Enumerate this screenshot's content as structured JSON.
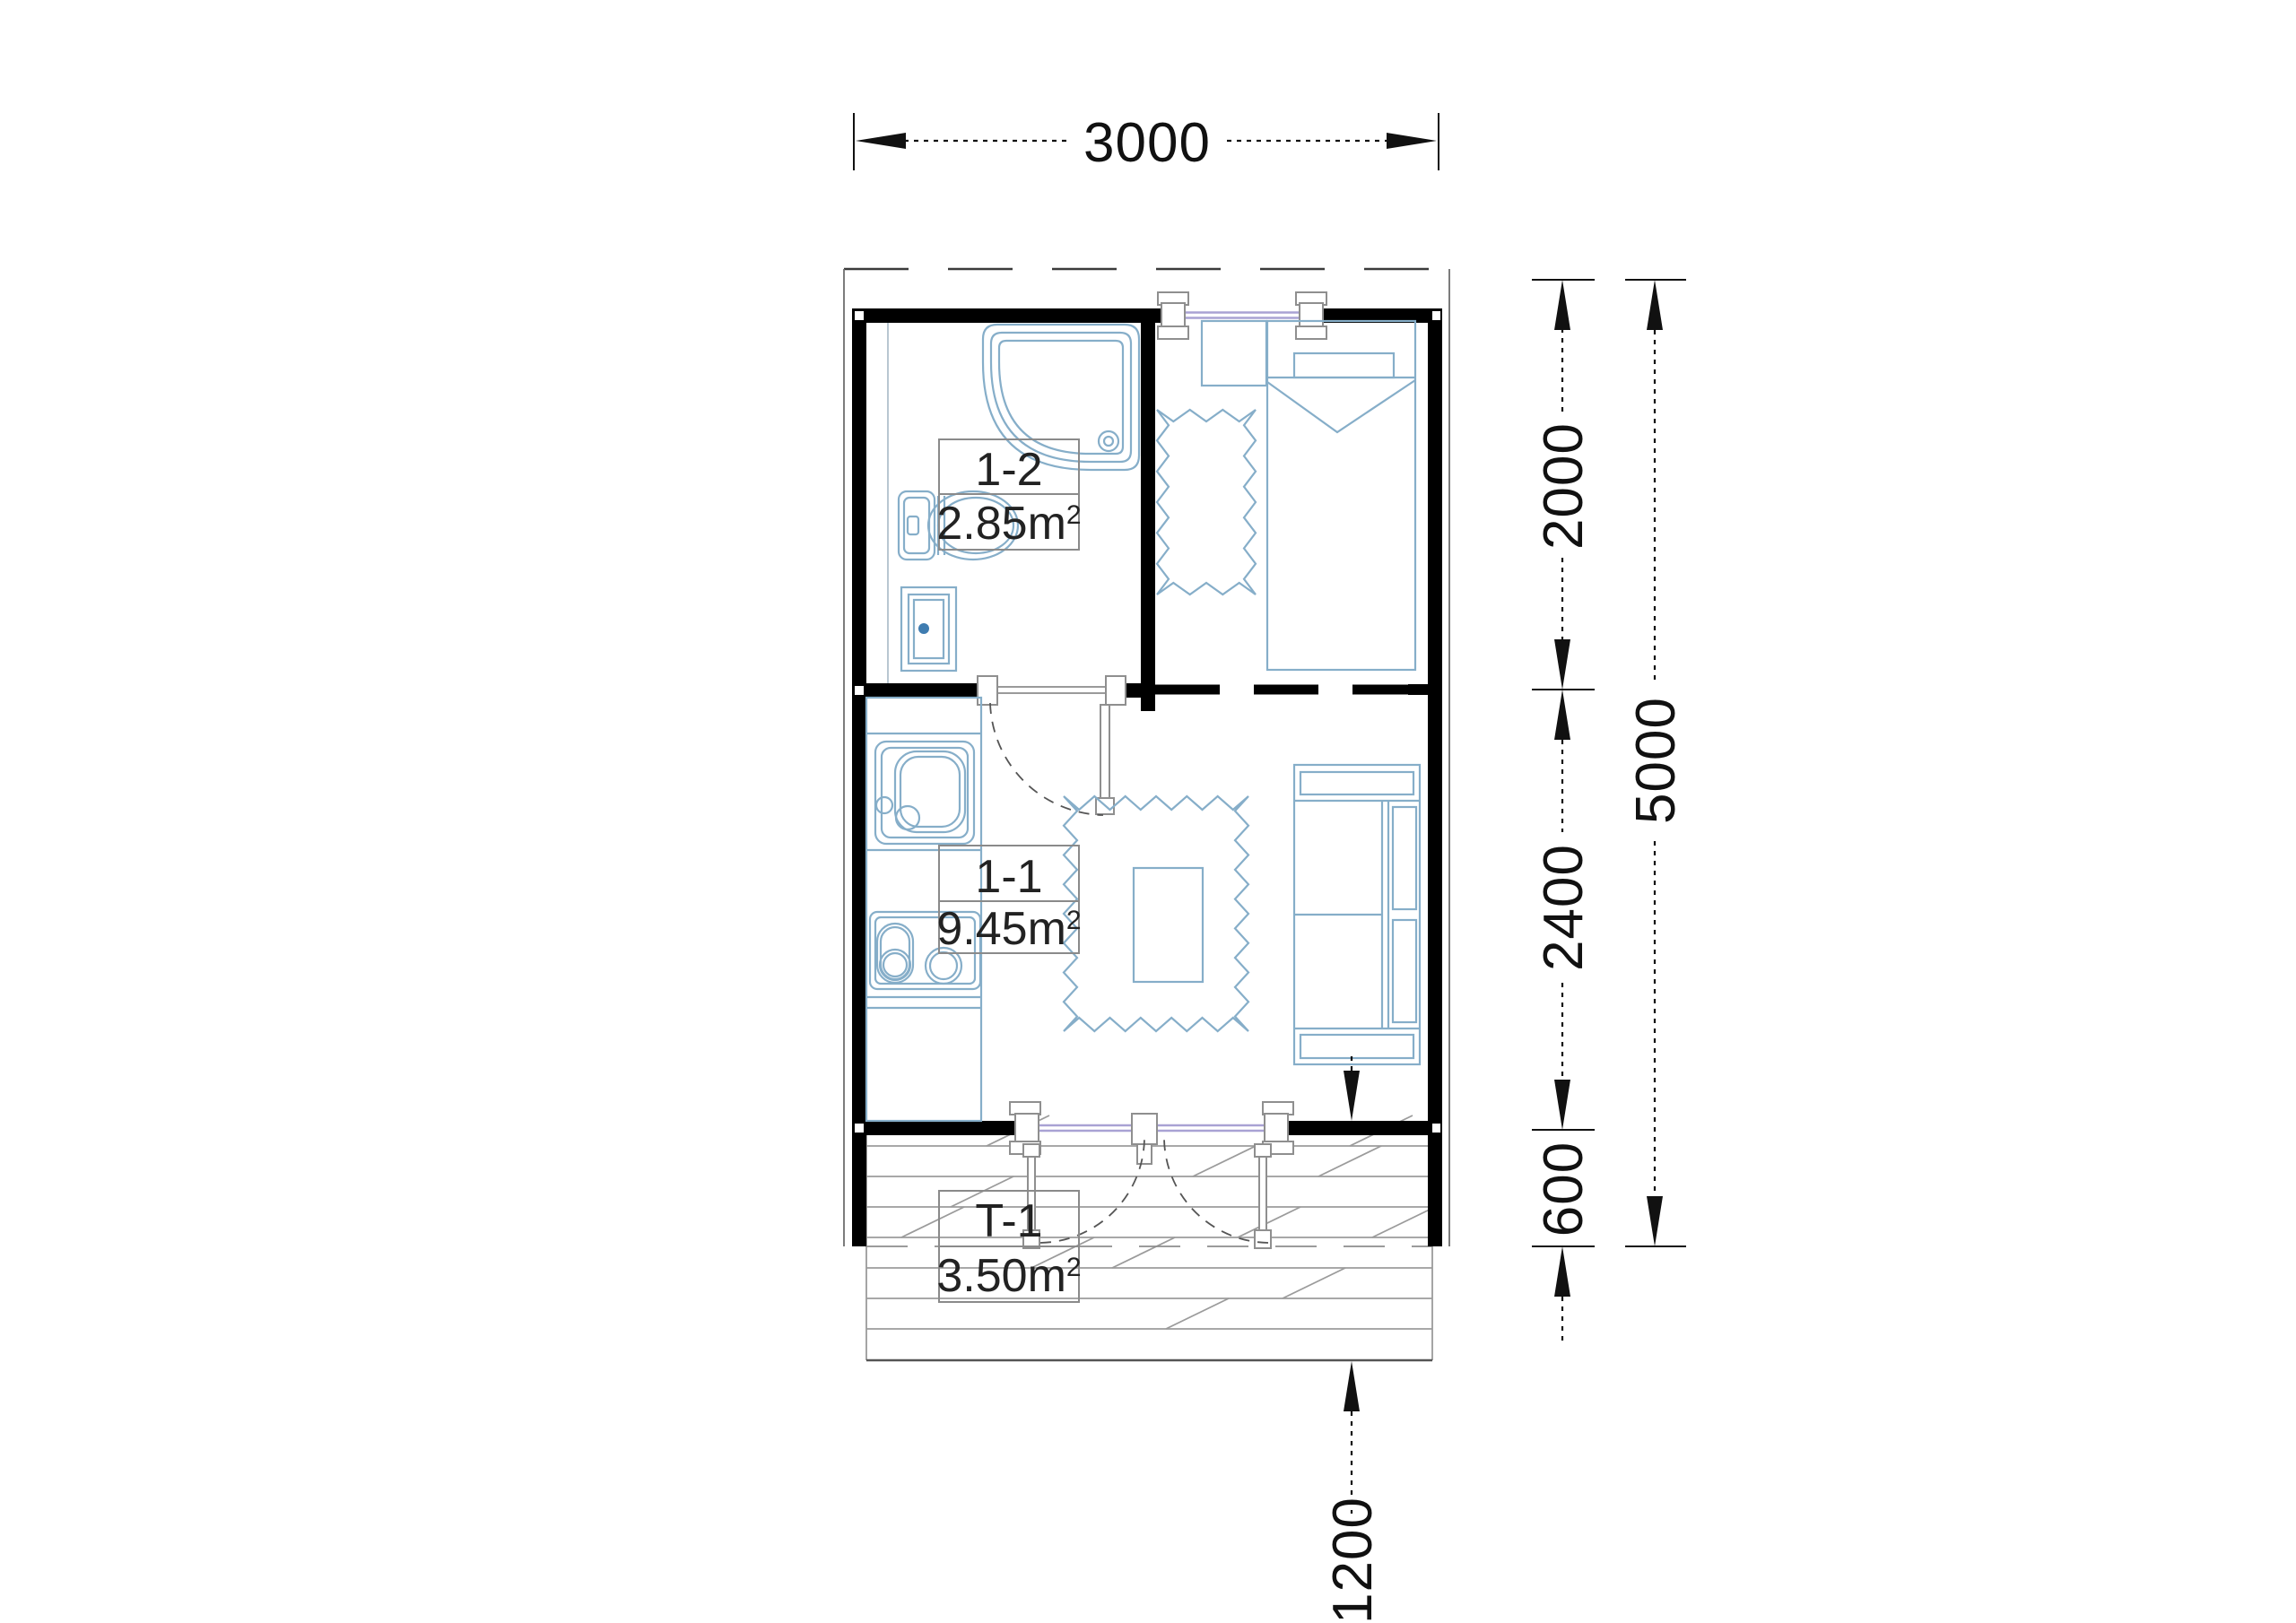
{
  "document": {
    "type": "floor-plan",
    "background": "#ffffff"
  },
  "rooms": {
    "bathroom": {
      "code": "1-2",
      "area": "2.85m",
      "area_exponent": "2"
    },
    "living_room": {
      "code": "1-1",
      "area": "9.45m",
      "area_exponent": "2"
    },
    "terrace": {
      "code": "T-1",
      "area": "3.50m",
      "area_exponent": "2"
    }
  },
  "dimensions": {
    "overall_width": "3000",
    "upper_rooms_depth": "2000",
    "living_room_depth": "2400",
    "roof_overhang_depth": "600",
    "overall_depth": "5000",
    "terrace_depth": "1200"
  },
  "colors": {
    "walls": "#000000",
    "furniture_outline": "#86aec9",
    "glazing": "#a9a2d4",
    "frame_gray": "#8f8f8f",
    "deck_lines": "#9b9b9b",
    "dimension_lines": "#111111",
    "label_border": "#8a8a8a",
    "label_text": "#222222"
  }
}
